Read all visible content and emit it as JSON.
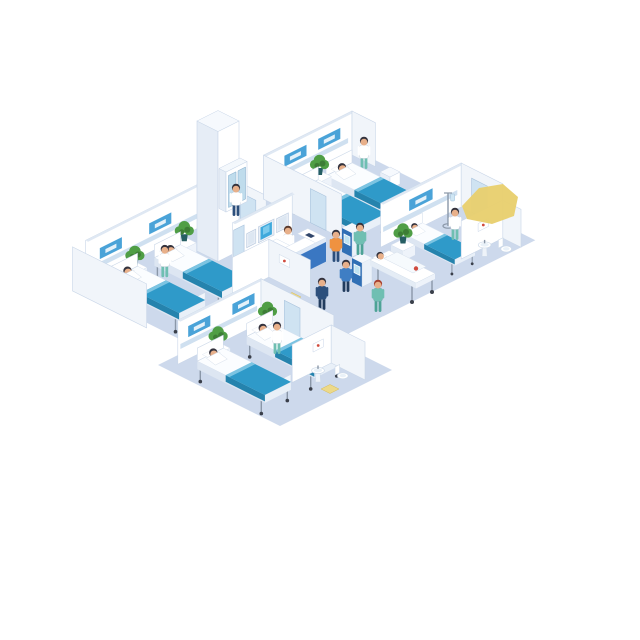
{
  "scene": {
    "label": "Isometric hospital ward floor illustration",
    "background": "#ffffff"
  },
  "reception": {
    "sign_text": "P&N"
  },
  "palette": {
    "bg": "#ffffff",
    "floor": "#cdd9ec",
    "wall": "#ffffff",
    "wallsw": "#f1f5fa",
    "wallcap": "#dfe8f3",
    "walledge": "#c9d6e8",
    "stripe": "#cfe0f0",
    "headwall": "#4aa3d8",
    "door": "#cfe3f2",
    "doorframe": "#a8c2dc",
    "bedside": "#dde6f2",
    "bedfoot": "#e9f0f8",
    "mattress": "#fbfdff",
    "blanket": "#2f9ac9",
    "blanketdark": "#2583ad",
    "blanketfold": "#7cc4e2",
    "skin": "#e8b08a",
    "hair": "#33323d",
    "hairred": "#a7402f",
    "coat": "#ffffff",
    "scrub": "#6fbfb2",
    "scrubdark": "#4da396",
    "navy": "#2c4f7c",
    "navydark": "#223c5e",
    "orange": "#ef9240",
    "blue": "#3f7ec4",
    "desk": "#2e66b0",
    "deskfront": "#3a77c2",
    "desksign": "#173f73",
    "screen": "#3fa9dc",
    "screenlite": "#bfe3f2",
    "frame": "#e8eef6",
    "kiosk": "#2f6fb5",
    "kioskside": "#eaf1f9",
    "plant": "#4f9e45",
    "plantdark": "#3d7d36",
    "pot": "#265e63",
    "steel": "#8a97a8",
    "wheel": "#3a3f4a",
    "yellow": "#e8cf6e",
    "yellowline": "#d9bd55",
    "red": "#d04b3e"
  },
  "inventory": {
    "wards": [
      {
        "id": "upper",
        "beds": 2,
        "patients": 2,
        "staff": 1,
        "plants": 1,
        "supply_carts": 1
      },
      {
        "id": "right",
        "beds": 1,
        "patients": 1,
        "staff": 1,
        "plants": 1,
        "iv_stands": 1
      },
      {
        "id": "left",
        "beds": 2,
        "patients": 2,
        "staff": 1,
        "plants": 2
      },
      {
        "id": "lower",
        "beds": 2,
        "patients": 2,
        "staff": 1,
        "plants": 2
      }
    ],
    "bathrooms": [
      {
        "id": "middle",
        "fixtures": [
          "sink",
          "wall-art",
          "mat"
        ]
      },
      {
        "id": "lower",
        "fixtures": [
          "sink",
          "toilet",
          "wall-art",
          "mat"
        ]
      },
      {
        "id": "right",
        "fixtures": [
          "sink",
          "toilet",
          "wall-art"
        ]
      }
    ],
    "lobby": {
      "reception_desks": 1,
      "receptionists": 1,
      "wall_monitors": 3,
      "checkin_kiosks": 2,
      "kiosk_users": 2,
      "stretchers": 1,
      "stretcher_patients": 1,
      "stretcher_attendants": 1,
      "walking_staff": 2,
      "corridor_staff": 1,
      "supply_cabinets": 1,
      "elevator_columns": 1,
      "doors": 5
    },
    "highlights": {
      "yellow_patches": 1
    }
  }
}
